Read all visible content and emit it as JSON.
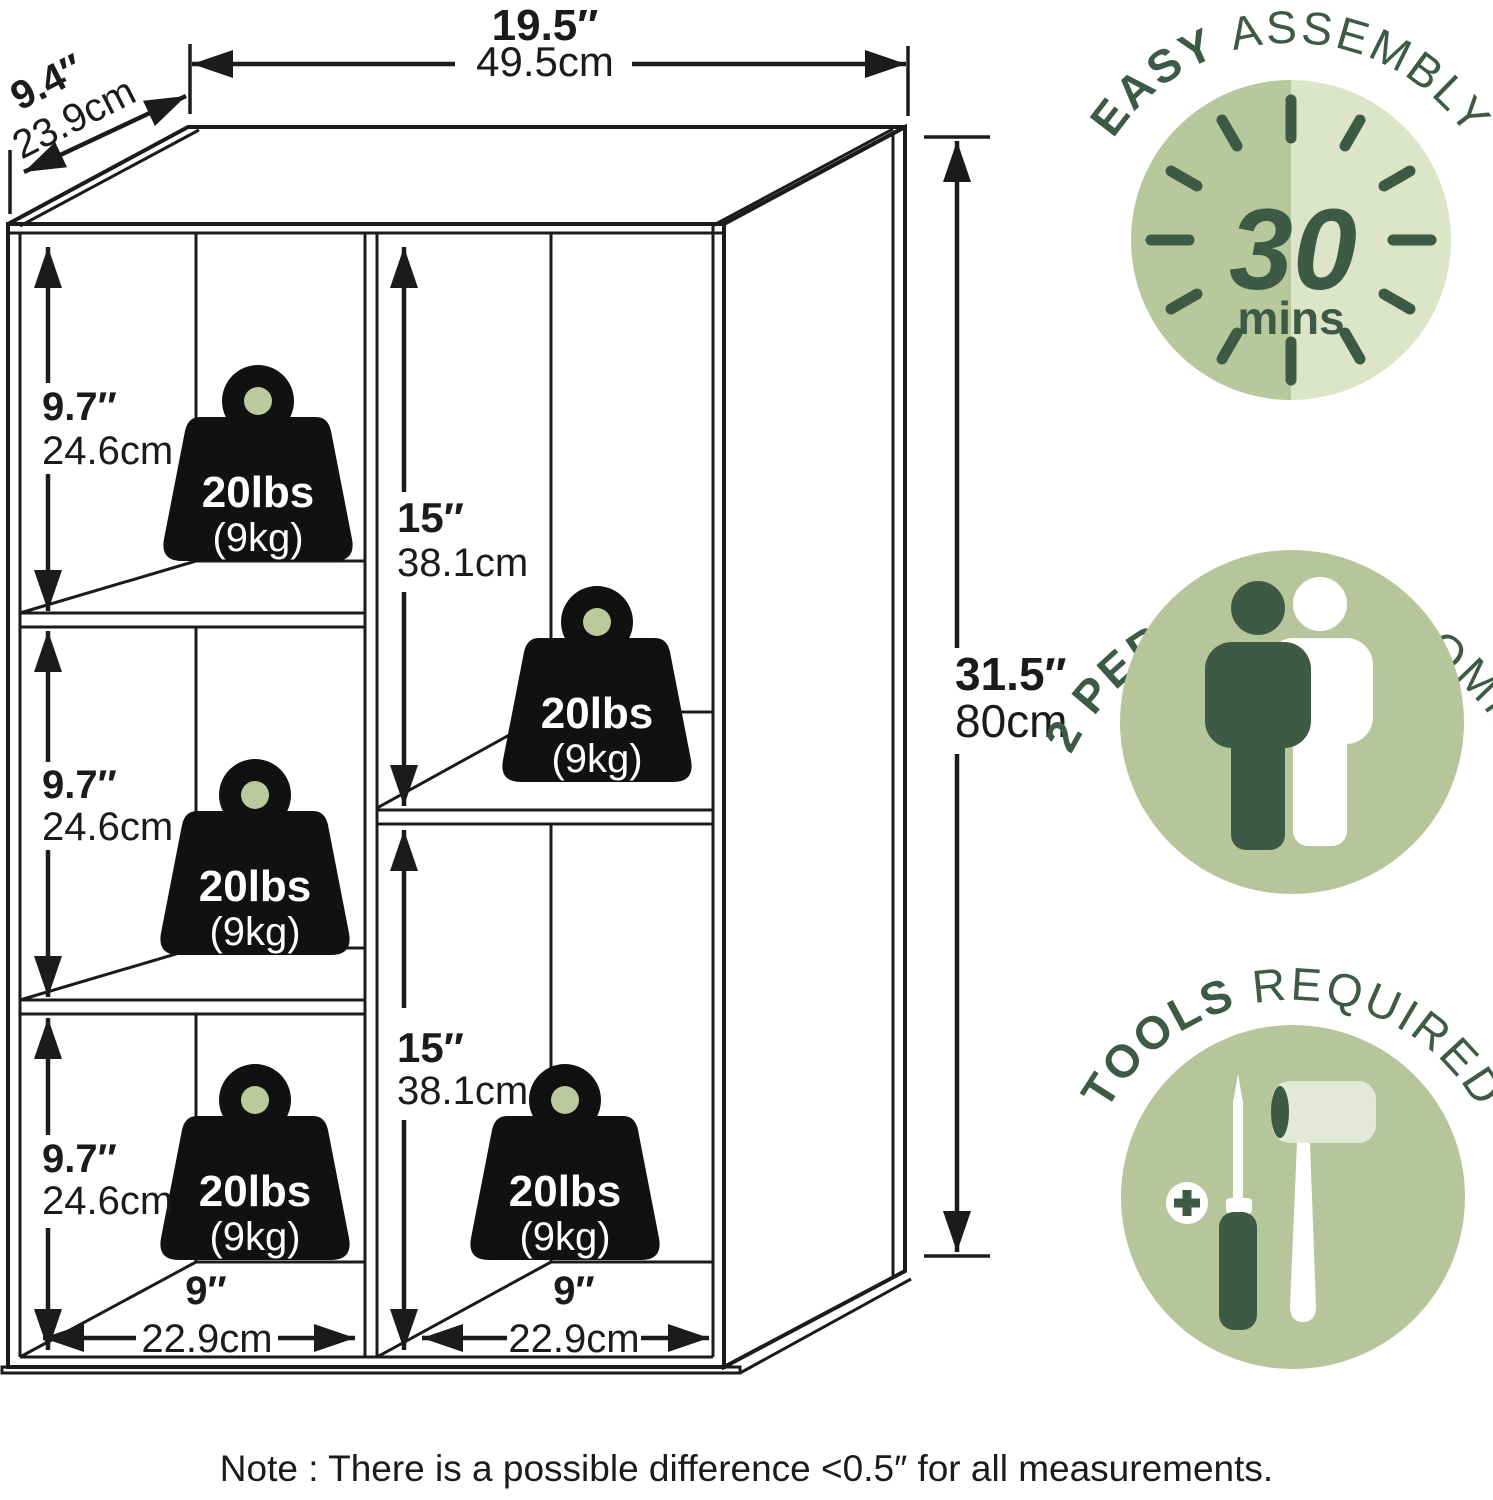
{
  "product_diagram": {
    "overall": {
      "width_in": "19.5″",
      "width_cm": "49.5cm",
      "depth_in": "9.4″",
      "depth_cm": "23.9cm",
      "height_in": "31.5″",
      "height_cm": "80cm"
    },
    "left_cell": {
      "height_in": "9.7″",
      "height_cm": "24.6cm"
    },
    "right_cell": {
      "height_in": "15″",
      "height_cm": "38.1cm"
    },
    "cell_width": {
      "width_in": "9″",
      "width_cm": "22.9cm"
    },
    "shelf_capacity": {
      "lbs": "20lbs",
      "kg": "(9kg)"
    }
  },
  "badges": [
    {
      "title_bold": "EASY ",
      "title_rest": "ASSEMBLY",
      "value": "30",
      "unit": "mins"
    },
    {
      "title_bold": "2 PERSONS ",
      "title_rest": "RECOMM."
    },
    {
      "title_bold": "TOOLS ",
      "title_rest": "REQUIRED"
    }
  ],
  "note": "Note : There is a possible difference <0.5″ for all measurements.",
  "colors": {
    "cabinet_front": "#bcc99d",
    "cabinet_top": "#c4cfa6",
    "cabinet_side": "#b4c294",
    "badge_green": "#b7c69a",
    "clock_light": "#dde5c8",
    "dark_green": "#3c5a44",
    "line_black": "#1b1b1b"
  }
}
